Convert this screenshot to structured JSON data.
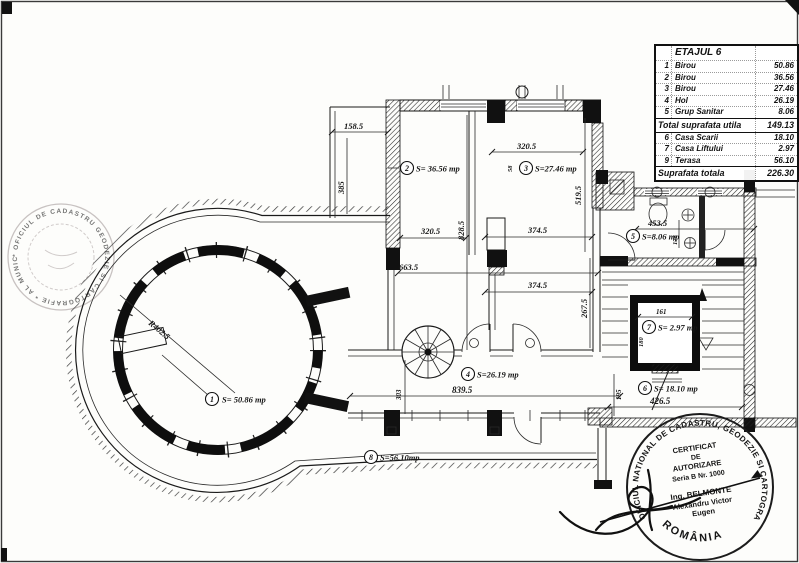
{
  "table": {
    "title": "ETAJUL 6",
    "rows": [
      {
        "num": "1",
        "name": "Birou",
        "value": "50.86"
      },
      {
        "num": "2",
        "name": "Birou",
        "value": "36.56"
      },
      {
        "num": "3",
        "name": "Birou",
        "value": "27.46"
      },
      {
        "num": "4",
        "name": "Hol",
        "value": "26.19"
      },
      {
        "num": "5",
        "name": "Grup Sanitar",
        "value": "8.06"
      }
    ],
    "total_utila_label": "Total suprafata utila",
    "total_utila_value": "149.13",
    "rows2": [
      {
        "num": "6",
        "name": "Casa Scarii",
        "value": "18.10"
      },
      {
        "num": "7",
        "name": "Casa Liftului",
        "value": "2.97"
      },
      {
        "num": "9",
        "name": "Terasa",
        "value": "56.10"
      }
    ],
    "total_label": "Suprafata totala",
    "total_value": "226.30"
  },
  "plan": {
    "rooms": [
      {
        "num": "1",
        "area": "S= 50.86 mp"
      },
      {
        "num": "2",
        "area": "S= 36.56 mp"
      },
      {
        "num": "3",
        "area": "S=27.46 mp"
      },
      {
        "num": "4",
        "area": "S=26.19 mp"
      },
      {
        "num": "5",
        "area": "S=8.06 mp"
      },
      {
        "num": "6",
        "area": "S= 18.10 mp"
      },
      {
        "num": "7",
        "area": "S= 2.97 mp"
      },
      {
        "num": "8",
        "area": "S=56.10mp"
      }
    ],
    "dims": {
      "strip_w": "158.5",
      "strip_h": "385",
      "r3_top": "320.5",
      "r3_right": "519.5",
      "r2_w": "320.5",
      "axis_h": "828.5",
      "mid1": "374.5",
      "mid2": "374.5",
      "mid_l": "663.5",
      "mid_r": "267.5",
      "san_w": "453.5",
      "san_d": "178",
      "wall_s": "58",
      "lift_w": "161",
      "lift_h": "180",
      "sc_w": "426.5",
      "sc_h": "195",
      "hol_w": "839.5",
      "hol_h": "303",
      "radius": "R402.5"
    }
  },
  "stamps": {
    "left": {
      "ring_text": "* OFICIUL DE CADASTRU GEODEZIE SI CARTOGRAFIE * AL MUNICIPIULUI BUCURESTI *"
    },
    "right": {
      "ring_text": "OFICIUL NATIONAL DE CADASTRU, GEODEZIE SI CARTOGRAFIE",
      "bottom_text": "ROMÂNIA",
      "line1": "CERTIFICAT",
      "line2": "DE",
      "line3": "AUTORIZARE",
      "line4": "Seria B Nr. 1000",
      "line5": "Ing. BELMONTE",
      "line6": "Alexandru Victor",
      "line7": "Eugen"
    }
  }
}
